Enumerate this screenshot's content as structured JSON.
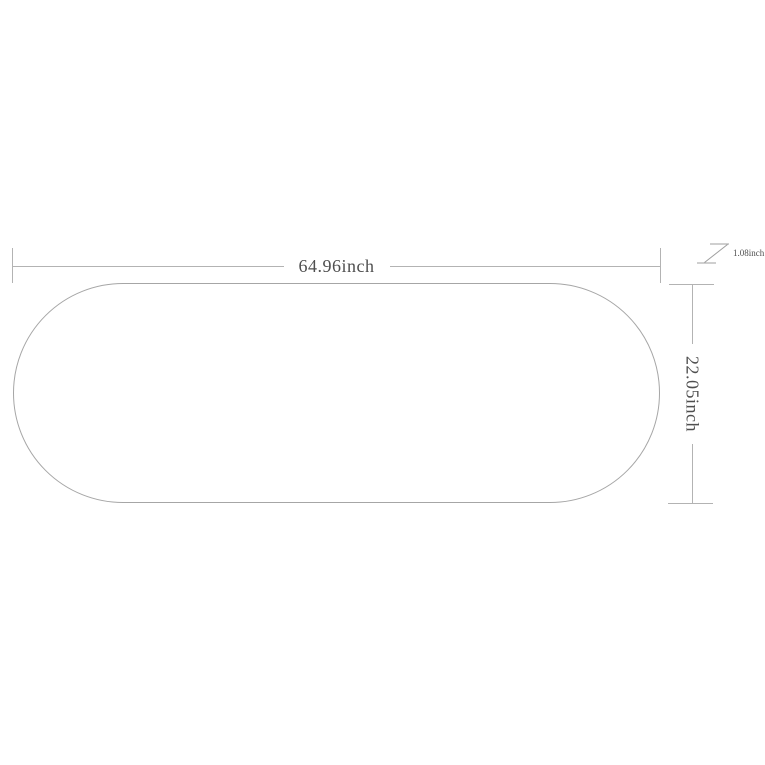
{
  "diagram": {
    "kind": "product-dimension-drawing",
    "shape": "oval-tabletop-outline",
    "width": {
      "label": "64.96inch"
    },
    "height": {
      "label": "22.05inch"
    },
    "thickness": {
      "label": "1.08inch"
    },
    "colors": {
      "outline": "#a6a6a6",
      "dimension_line": "#b3b3b3",
      "text": "#4f4f4f",
      "background": "#ffffff"
    }
  }
}
